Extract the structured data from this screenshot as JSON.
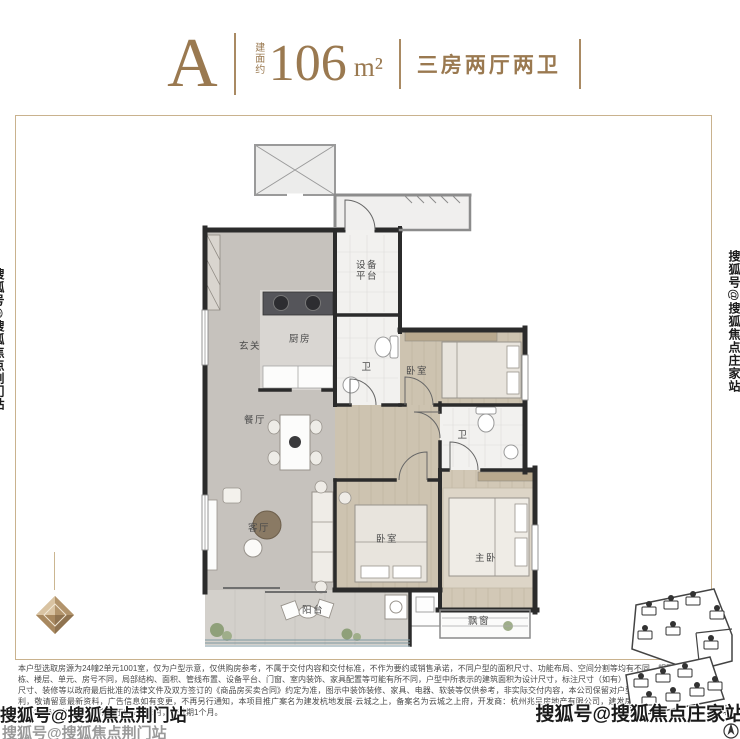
{
  "header": {
    "unit": "A",
    "area_label": "建面约",
    "area_value": "106",
    "area_unit": "m²",
    "layout": "三房两厅两卫"
  },
  "plan": {
    "rooms": [
      {
        "label": "玄关"
      },
      {
        "label": "厨房"
      },
      {
        "label": "设备平台"
      },
      {
        "label": "卫"
      },
      {
        "label": "餐厅"
      },
      {
        "label": "卧室"
      },
      {
        "label": "卫"
      },
      {
        "label": "客厅"
      },
      {
        "label": "卧室"
      },
      {
        "label": "主卧"
      },
      {
        "label": "阳台"
      },
      {
        "label": "飘窗"
      }
    ]
  },
  "sitemap": {
    "compass_label": "北"
  },
  "disclaimer": {
    "text": "本户型选取房源为24幢2单元1001室，仅为户型示意，仅供购房参考，不属于交付内容和交付标准，不作为要约或销售承诺，不同户型的面积尺寸、功能布局、空间分割等均有不同，相同户型因楼栋、楼层、单元、房号不同，局部结构、面积、管线布置、设备平台、门窗、室内装饰、家具配置等可能有所不同，户型中所表示的建筑面积为设计尺寸，标注尺寸（如有）仅供参考，具体面积、尺寸、装修等以政府最后批准的法律文件及双方签订的《商品房买卖合同》约定为准，图示中装饰装修、家具、电器、软装等仅供参考，非实际交付内容，本公司保留对户型示意图进行修改的权利，敬请留意最新资料，广告信息如有变更，不再另行通知，本项目推广案名为建发杭地发展·云城之上，备案名为云城之上府，开发商：杭州兆呈房地产有限公司，建发房产全国统一热线400-846-3636；本宣传资料制作于2024年6月，有效期1个月。"
  },
  "watermarks": {
    "bottom_left": "搜狐号@搜狐焦点荆门站",
    "bottom_left_ghost": "搜狐号@搜狐焦点荆门站",
    "bottom_right": "搜狐号@搜狐焦点庄家站",
    "right_edge": "搜狐号@搜狐焦点庄家站",
    "left_edge": "搜狐号@搜狐焦点荆门站"
  },
  "colors": {
    "accent": "#9a7950",
    "wall": "#2b2b2b",
    "border": "#c9b28e"
  }
}
